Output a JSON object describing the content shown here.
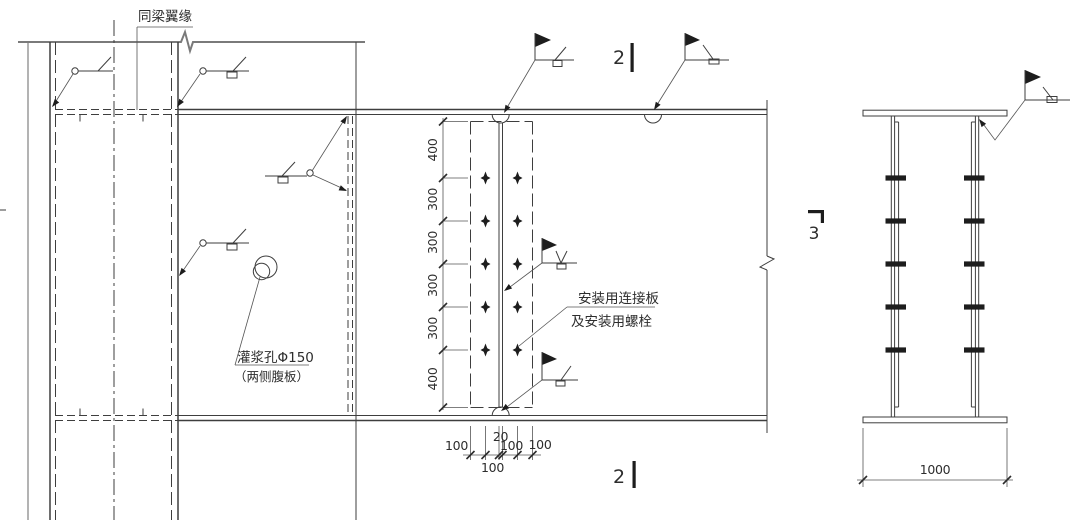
{
  "drawing": {
    "labels": {
      "beam_flange_note": "同梁翼缘",
      "grout_hole_line1": "灌浆孔Φ150",
      "grout_hole_line2": "（两侧腹板）",
      "splice_note_line1": "安装用连接板",
      "splice_note_line2": "及安装用螺栓"
    },
    "section_markers": {
      "top": "2",
      "bottom": "2",
      "side": "3"
    },
    "dims": {
      "vertical": [
        "400",
        "300",
        "300",
        "300",
        "300",
        "400"
      ],
      "bottom_chain": [
        "100",
        "100",
        "20",
        "100",
        "100"
      ],
      "section_width": "1000"
    },
    "colors": {
      "line": "#3e3e3e",
      "gray_line": "#b3b3b3"
    }
  }
}
